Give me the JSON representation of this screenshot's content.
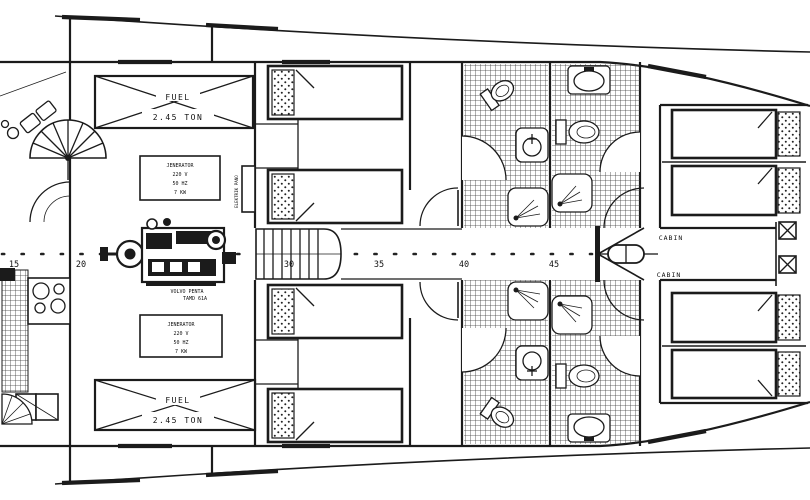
{
  "colors": {
    "ink": "#1b1b1b",
    "paper": "#ffffff"
  },
  "engine_room": {
    "fuel_tank_top": {
      "name_label": "FUEL",
      "capacity_label": "2.45 TON"
    },
    "fuel_tank_bottom": {
      "name_label": "FUEL",
      "capacity_label": "2.45 TON"
    },
    "generator_top": {
      "lines": [
        "JENERATOR",
        "220 V",
        "50 HZ",
        "7 KW"
      ]
    },
    "generator_bottom": {
      "lines": [
        "JENERATOR",
        "220 V",
        "50 HZ",
        "7 KW"
      ]
    },
    "engine": {
      "make_label": "VOLVO PENTA",
      "model_label": "TAMD 61A"
    },
    "electric_panel_label": "ELEKTRIK PANO"
  },
  "cabins": {
    "upper_label": "CABIN",
    "lower_label": "CABIN"
  },
  "ruler": {
    "ticks": [
      {
        "label": "15",
        "x": 14
      },
      {
        "label": "20",
        "x": 81
      },
      {
        "label": "30",
        "x": 289
      },
      {
        "label": "35",
        "x": 379
      },
      {
        "label": "40",
        "x": 464
      },
      {
        "label": "45",
        "x": 554
      }
    ]
  }
}
